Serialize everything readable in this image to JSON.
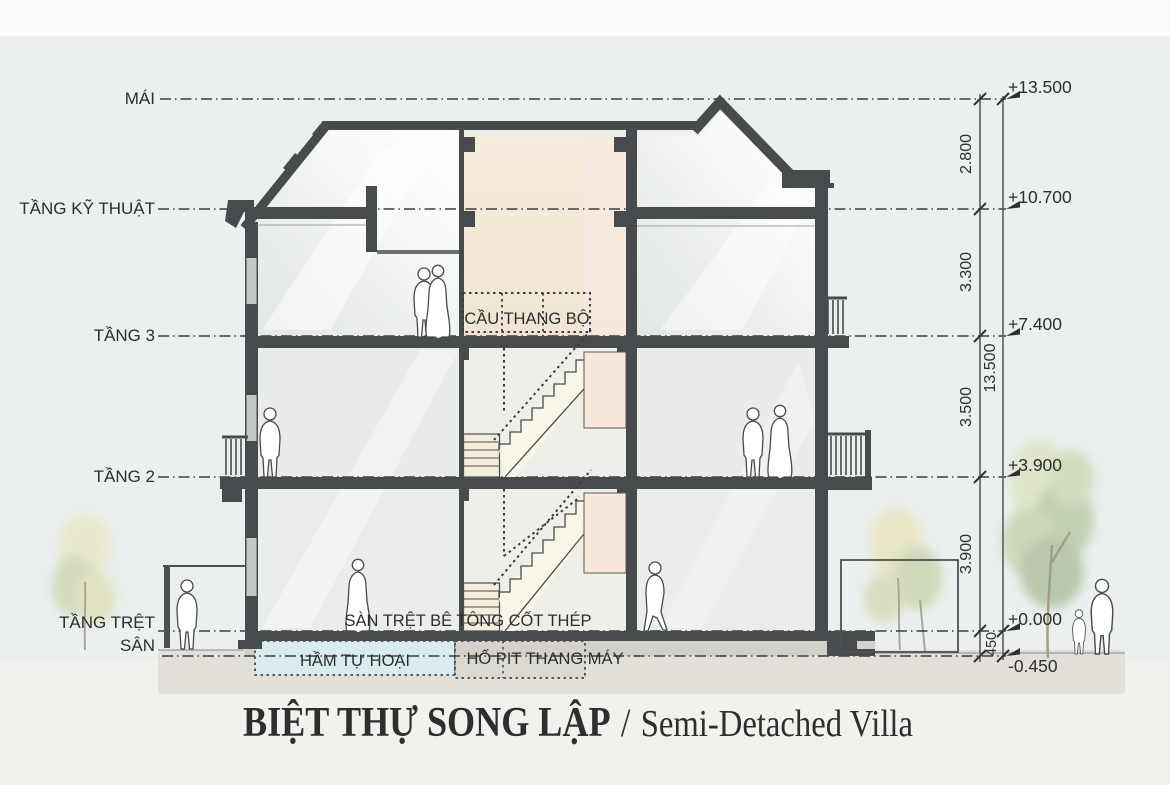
{
  "title": {
    "vi": "BIỆT THỰ SONG LẬP",
    "divider": "/",
    "en": "Semi-Detached Villa",
    "color": "#a87e57"
  },
  "levels": [
    {
      "label": "MÁI",
      "elevation": "+13.500"
    },
    {
      "label": "TẦNG KỸ THUẬT",
      "elevation": "+10.700"
    },
    {
      "label": "TẦNG 3",
      "elevation": "+7.400"
    },
    {
      "label": "TẦNG 2",
      "elevation": "+3.900"
    },
    {
      "label": "TẦNG TRỆT",
      "elevation": "+0.000"
    },
    {
      "label": "SÂN",
      "elevation": "-0.450"
    }
  ],
  "dimensions": {
    "segments": [
      "2.800",
      "3.300",
      "3.500",
      "3.900"
    ],
    "plinth": "450",
    "total": "13.500"
  },
  "room_labels": {
    "staircase": "CẦU THANG BỘ",
    "ground_slab": "SÀN TRỆT BÊ TÔNG CỐT THÉP",
    "septic_tank": "HẦM TỰ HOẠI",
    "elevator_pit": "HỐ PIT THANG MÁY"
  },
  "colors": {
    "structure": "#474b4e",
    "shaft_fill": "#f2e9d9",
    "elevator_fill": "#f7e6da",
    "septic_fill": "#d9edf1",
    "background": "#ebefee",
    "title_accent": "#a87e57"
  }
}
